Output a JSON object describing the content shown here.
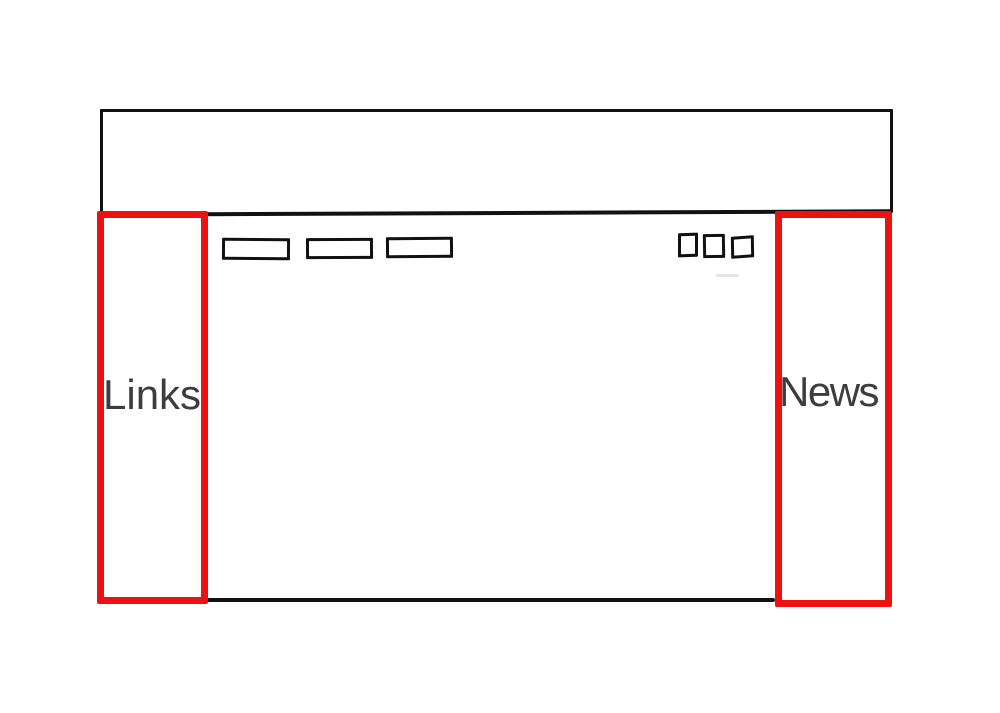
{
  "wireframe": {
    "links_panel": {
      "label": "Links"
    },
    "news_panel": {
      "label": "News"
    },
    "header": {
      "content": ""
    },
    "nav_buttons": {
      "count": 3
    },
    "toolbar_squares": {
      "count": 3
    }
  },
  "colors": {
    "background": "#ffffff",
    "ink": "#111111",
    "annotation_red": "#ee1111",
    "label_text": "#3d3d3d"
  }
}
